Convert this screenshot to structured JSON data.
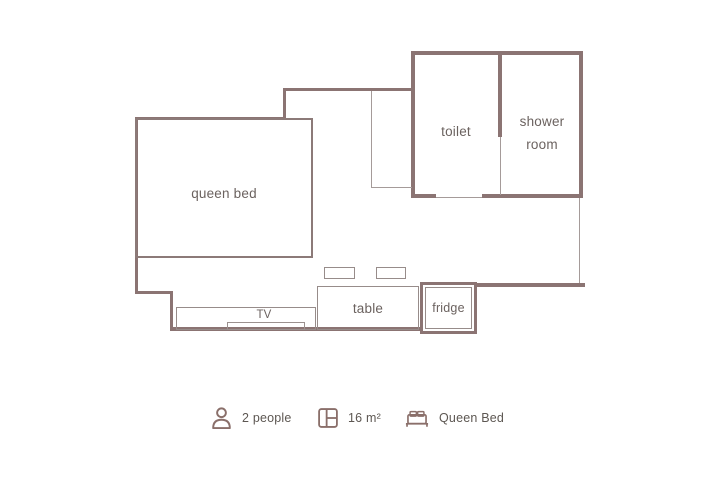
{
  "floorplan": {
    "labels": {
      "queen_bed": "queen bed",
      "toilet": "toilet",
      "shower_room": "shower room",
      "tv": "TV",
      "table": "table",
      "fridge": "fridge"
    },
    "colors": {
      "wall": "#8b7473",
      "furniture_line": "#978c8a",
      "room_label_text": "#6b625f",
      "legend_text": "#5d5752",
      "legend_icon": "#8a6f6a",
      "background": "#ffffff"
    }
  },
  "legend": {
    "items": [
      {
        "icon": "person-icon",
        "label": "2 people"
      },
      {
        "icon": "floorplan-icon",
        "label": "16 m²"
      },
      {
        "icon": "bed-icon",
        "label": "Queen Bed"
      }
    ]
  }
}
